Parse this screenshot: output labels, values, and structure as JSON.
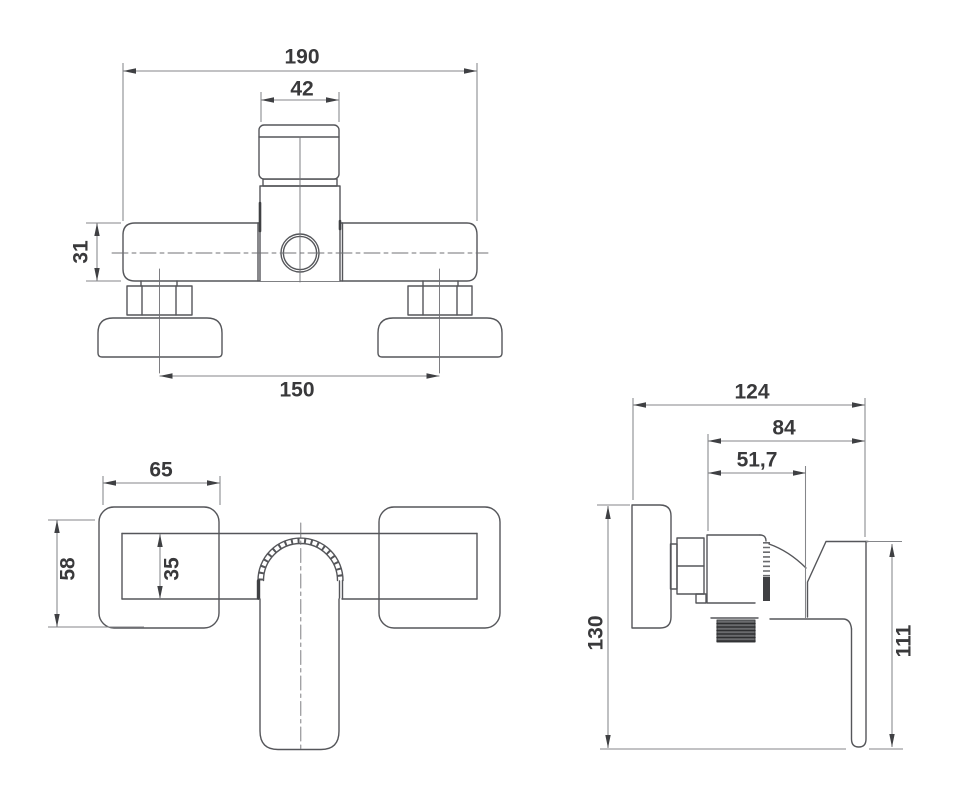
{
  "drawing": {
    "type": "technical-dimension-drawing",
    "subject": "wall-mounted shower mixer tap, three orthographic views",
    "unit": "mm",
    "colors": {
      "background": "#ffffff",
      "object_line": "#55565a",
      "dimension_line": "#85868a",
      "arrow": "#3f4043",
      "text": "#39393b",
      "thread_fill": "#6a6b6e"
    },
    "views": [
      {
        "id": "top-view",
        "dimensions": [
          {
            "name": "overall-body-width",
            "value": "190"
          },
          {
            "name": "cartridge-cap-width",
            "value": "42"
          },
          {
            "name": "body-depth",
            "value": "31"
          },
          {
            "name": "connection-centres",
            "value": "150"
          }
        ]
      },
      {
        "id": "front-view",
        "dimensions": [
          {
            "name": "escutcheon-width",
            "value": "65"
          },
          {
            "name": "escutcheon-height",
            "value": "58"
          },
          {
            "name": "body-bar-height",
            "value": "35"
          }
        ]
      },
      {
        "id": "side-view",
        "dimensions": [
          {
            "name": "overall-depth",
            "value": "124"
          },
          {
            "name": "depth-to-handle-front",
            "value": "84"
          },
          {
            "name": "body-front-depth",
            "value": "51,7"
          },
          {
            "name": "overall-height",
            "value": "130"
          },
          {
            "name": "handle-drop-height",
            "value": "111"
          }
        ]
      }
    ]
  }
}
